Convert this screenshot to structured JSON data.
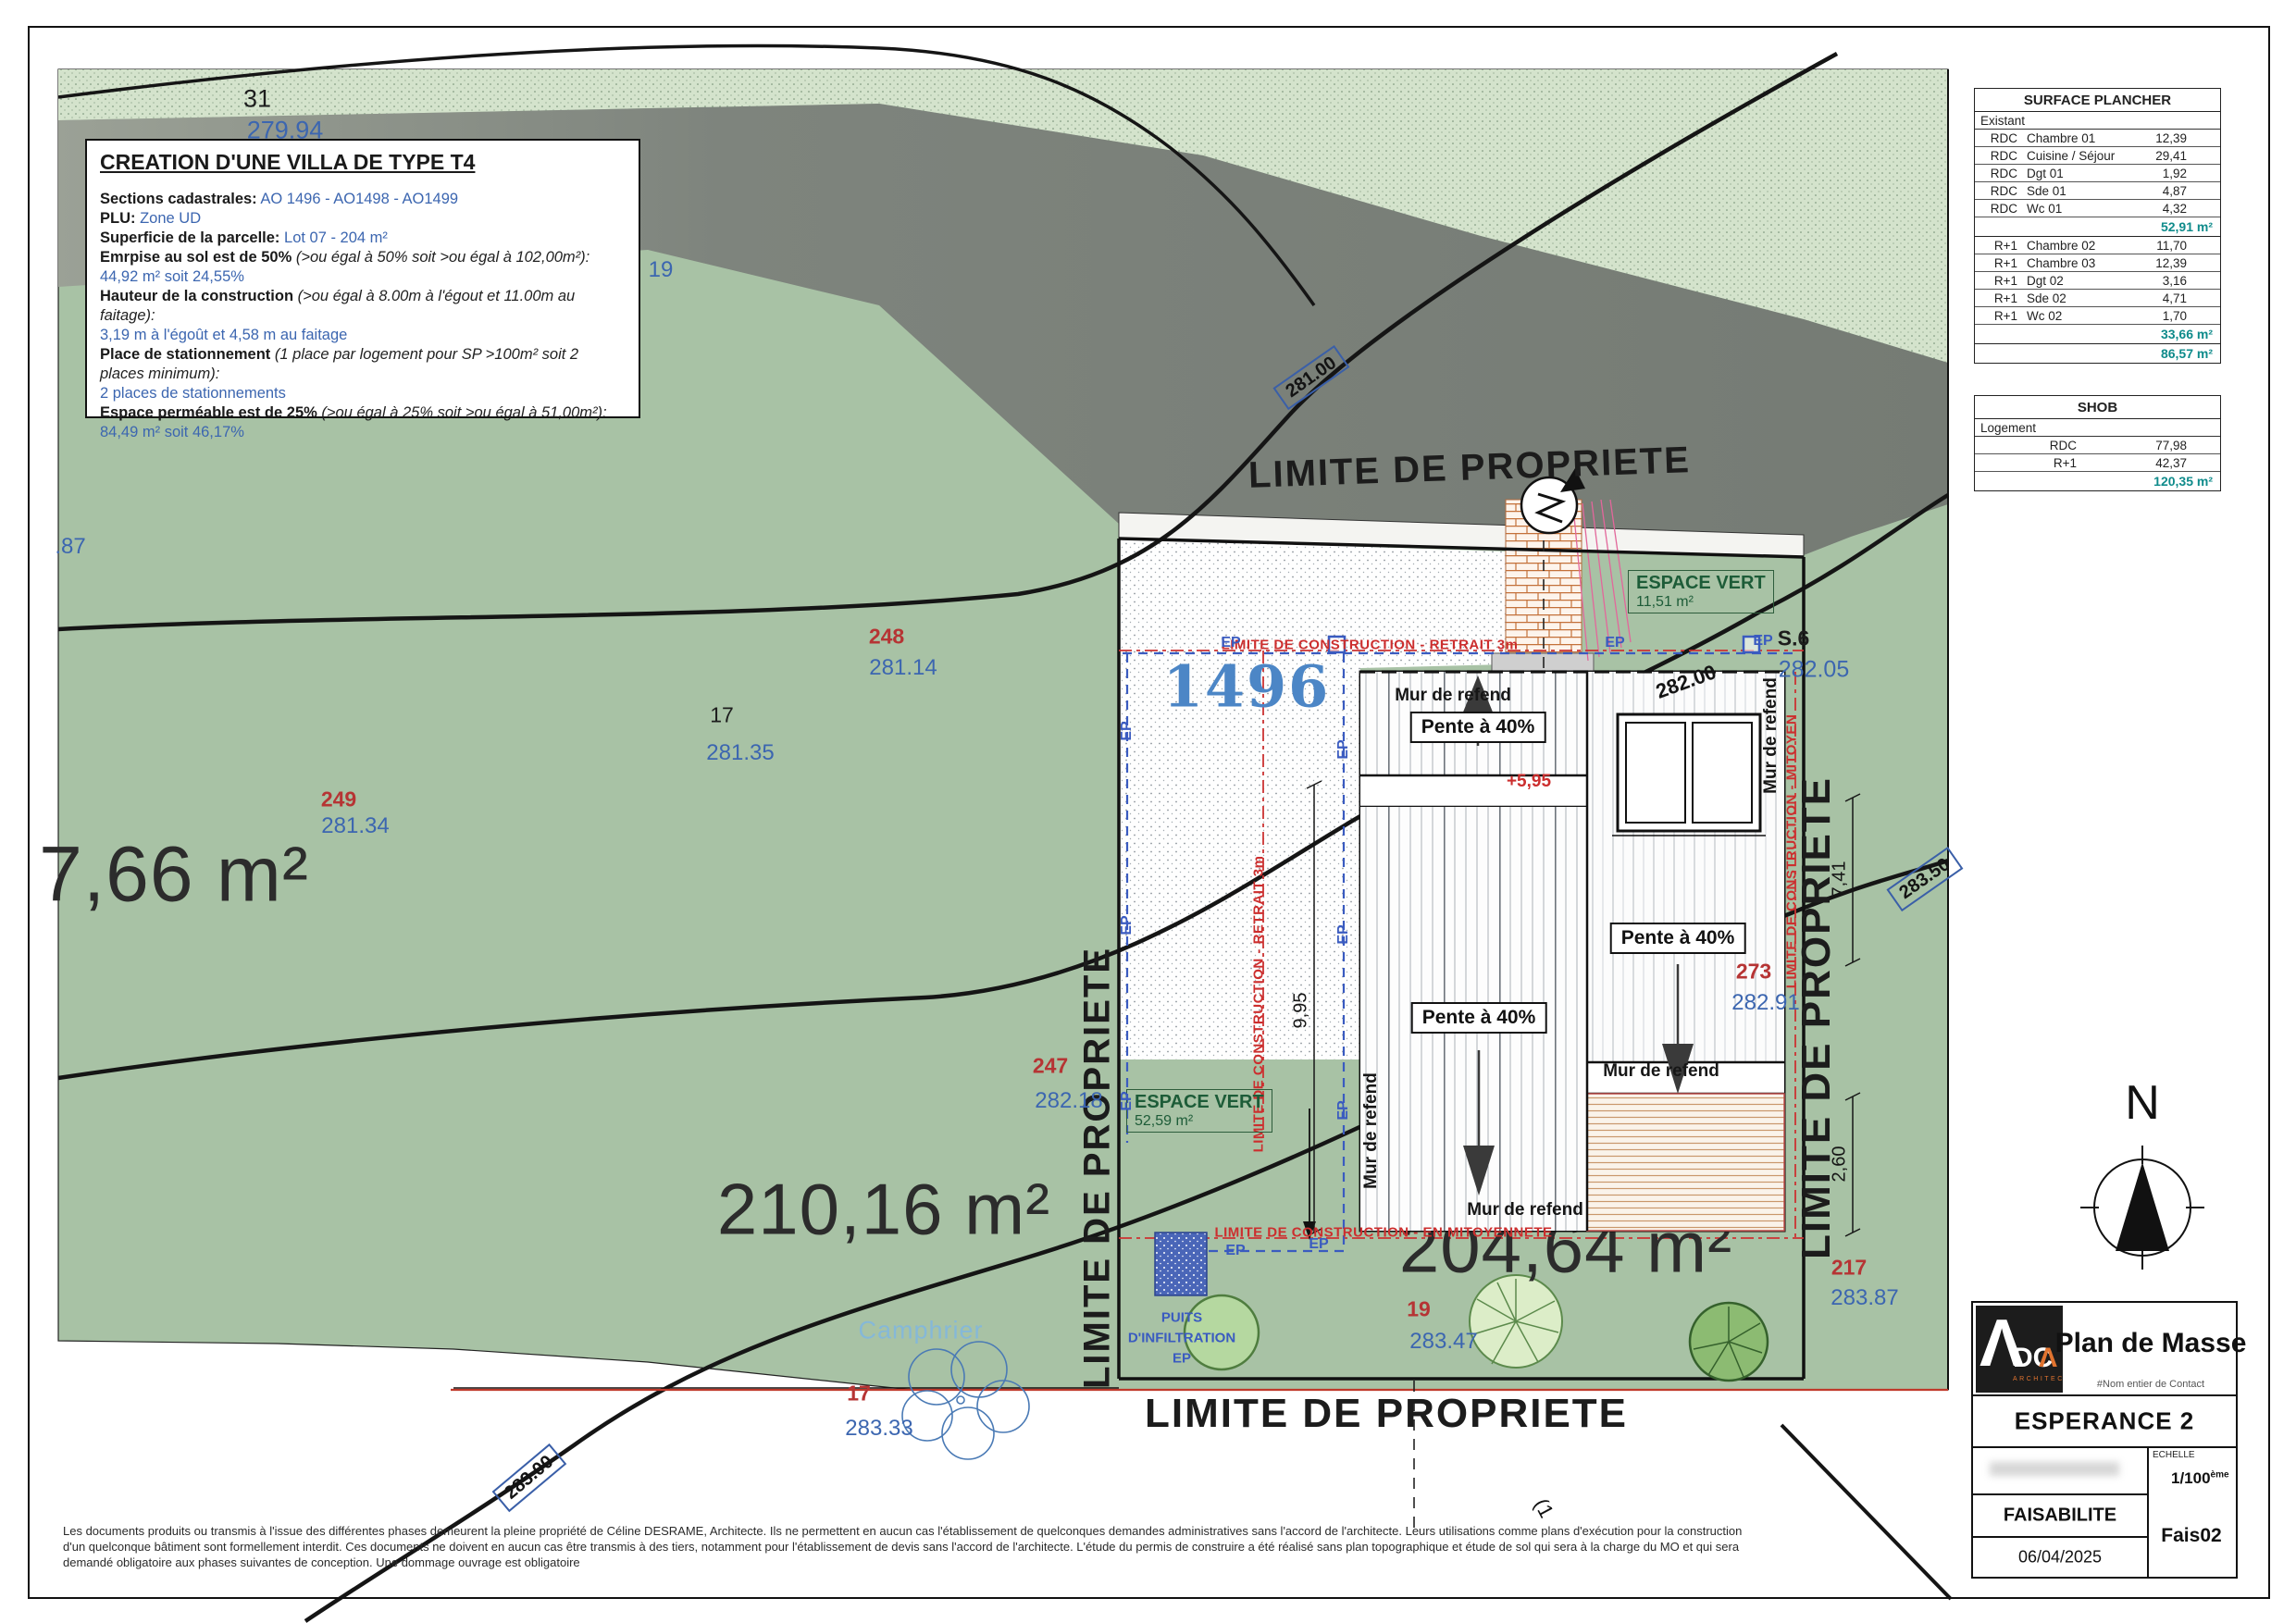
{
  "colors": {
    "sage": "#a8c2a5",
    "light_strip": "#d4e3cc",
    "road": "#82887f",
    "teal_total": "#0f8b8b",
    "elevation_blue": "#3c66b0",
    "parcel_red": "#b63434",
    "construction_red": "#cc2e2e",
    "ep_blue": "#3a5bc0",
    "parcel_blue": "#4c86c6",
    "logo_orange": "#e0732f"
  },
  "infobox": {
    "title": "CREATION D'UNE VILLA DE TYPE T4",
    "l1": {
      "label": "Sections cadastrales:",
      "value": "AO 1496 - AO1498 - AO1499"
    },
    "l2": {
      "label": "PLU:",
      "value": "Zone UD"
    },
    "l3": {
      "label": "Superficie de la parcelle:",
      "value": "Lot 07 - 204 m²"
    },
    "l4": {
      "label": "Emrpise au sol est de 50%",
      "note": "(>ou égal à 50% soit >ou égal à 102,00m²):",
      "value": "44,92 m² soit 24,55%"
    },
    "l5": {
      "label": "Hauteur de la construction",
      "note": "(>ou égal à 8.00m à l'égout et 11.00m au faitage):",
      "value": "3,19 m à l'égoût et 4,58 m au faitage"
    },
    "l6": {
      "label": "Place de stationnement",
      "note": "(1 place par logement pour SP >100m² soit 2 places minimum):",
      "value": "2 places de stationnements"
    },
    "l7": {
      "label": "Espace perméable est de 25%",
      "note": "(>ou égal à 25% soit >ou égal à 51,00m²):",
      "value": "84,49 m² soit 46,17%"
    }
  },
  "surface_table": {
    "title": "SURFACE PLANCHER",
    "group": "Existant",
    "rows": [
      {
        "level": "RDC",
        "room": "Chambre 01",
        "area": "12,39"
      },
      {
        "level": "RDC",
        "room": "Cuisine / Séjour",
        "area": "29,41"
      },
      {
        "level": "RDC",
        "room": "Dgt 01",
        "area": "1,92"
      },
      {
        "level": "RDC",
        "room": "Sde 01",
        "area": "4,87"
      },
      {
        "level": "RDC",
        "room": "Wc 01",
        "area": "4,32"
      },
      {
        "level": "R+1",
        "room": "Chambre 02",
        "area": "11,70"
      },
      {
        "level": "R+1",
        "room": "Chambre 03",
        "area": "12,39"
      },
      {
        "level": "R+1",
        "room": "Dgt 02",
        "area": "3,16"
      },
      {
        "level": "R+1",
        "room": "Sde 02",
        "area": "4,71"
      },
      {
        "level": "R+1",
        "room": "Wc 02",
        "area": "1,70"
      }
    ],
    "rdc_total": "52,91 m²",
    "r1_total": "33,66 m²",
    "total": "86,57 m²"
  },
  "shob_table": {
    "title": "SHOB",
    "group": "Logement",
    "rows": [
      {
        "level": "RDC",
        "area": "77,98"
      },
      {
        "level": "R+1",
        "area": "42,37"
      }
    ],
    "total": "120,35 m²"
  },
  "titleblock": {
    "doc_title": "Plan de Masse",
    "contact": "#Nom entier de Contact",
    "project": "ESPERANCE 2",
    "scale_label": "ECHELLE",
    "scale_num": "1/100",
    "scale_sup": "ème",
    "phase": "FAISABILITE",
    "date": "06/04/2025",
    "ref": "Fais02",
    "logo_mark": "Λ",
    "logo_letters": "DC",
    "logo_mark2": "Λ",
    "logo_sub": "ARCHITECTES"
  },
  "plan": {
    "limite_propriete": "LIMITE DE PROPRIETE",
    "lc_retrait": "LIMITE DE CONSTRUCTION - RETRAIT 3m",
    "lc_mitoyen": "LIMITE DE CONSTRUCTION - MITOYEN",
    "lc_en_mitoyennete": "LIMITE DE CONSTRUCTION - EN MITOYENNETE",
    "parcel_id": "1496",
    "area_left": "7,66 m²",
    "area_center": "210,16 m²",
    "area_right": "204,64 m²",
    "ev_label": "ESPACE VERT",
    "ev1_area": "11,51 m²",
    "ev2_area": "52,59 m²",
    "slope": "Pente à 40%",
    "wall": "Mur de refend",
    "pts": {
      "p31": "31",
      "e31": "279.94",
      "e87": ".87",
      "e19t": "19",
      "p248": "248",
      "e248": "281.14",
      "p17a": "17",
      "e17a": "281.35",
      "p249": "249",
      "e249": "281.34",
      "p247": "247",
      "e247": "282.18",
      "p273": "273",
      "e273": "282.91",
      "p19": "19",
      "e19": "283.47",
      "p217": "217",
      "e217": "283.87",
      "p17b": "17",
      "e17b": "283.33"
    },
    "contours": {
      "c281": "281.00",
      "c282": "282.00",
      "c283": "283.00",
      "c2835": "283.50"
    },
    "dims": {
      "d995": "9,95",
      "d741": "7,41",
      "d260": "2,60",
      "ridge": "+5,95"
    },
    "bench": "S.6",
    "bench_elev": "282.05",
    "tree_species": "Camphrier",
    "puits1": "PUITS",
    "puits2": "D'INFILTRATION",
    "puits3": "EP",
    "ep": "EP",
    "north": "N",
    "cut": "(1"
  },
  "disclaimer": {
    "l1": "Les documents produits ou transmis à l'issue des différentes phases demeurent la pleine propriété de Céline DESRAME, Architecte. Ils ne permettent en aucun cas l'établissement de quelconques demandes administratives sans l'accord de l'architecte. Leurs utilisations comme plans d'exécution pour la construction",
    "l2": "d'un quelconque bâtiment sont formellement interdit. Ces documents ne doivent en aucun cas être transmis à des tiers, notamment pour l'établissement de devis sans l'accord de l'architecte. L'étude du permis de construire a été réalisé sans plan topographique et étude de sol qui sera à la charge du MO et qui sera",
    "l3": "demandé obligatoire aux phases suivantes de conception. Une dommage ouvrage est obligatoire"
  }
}
